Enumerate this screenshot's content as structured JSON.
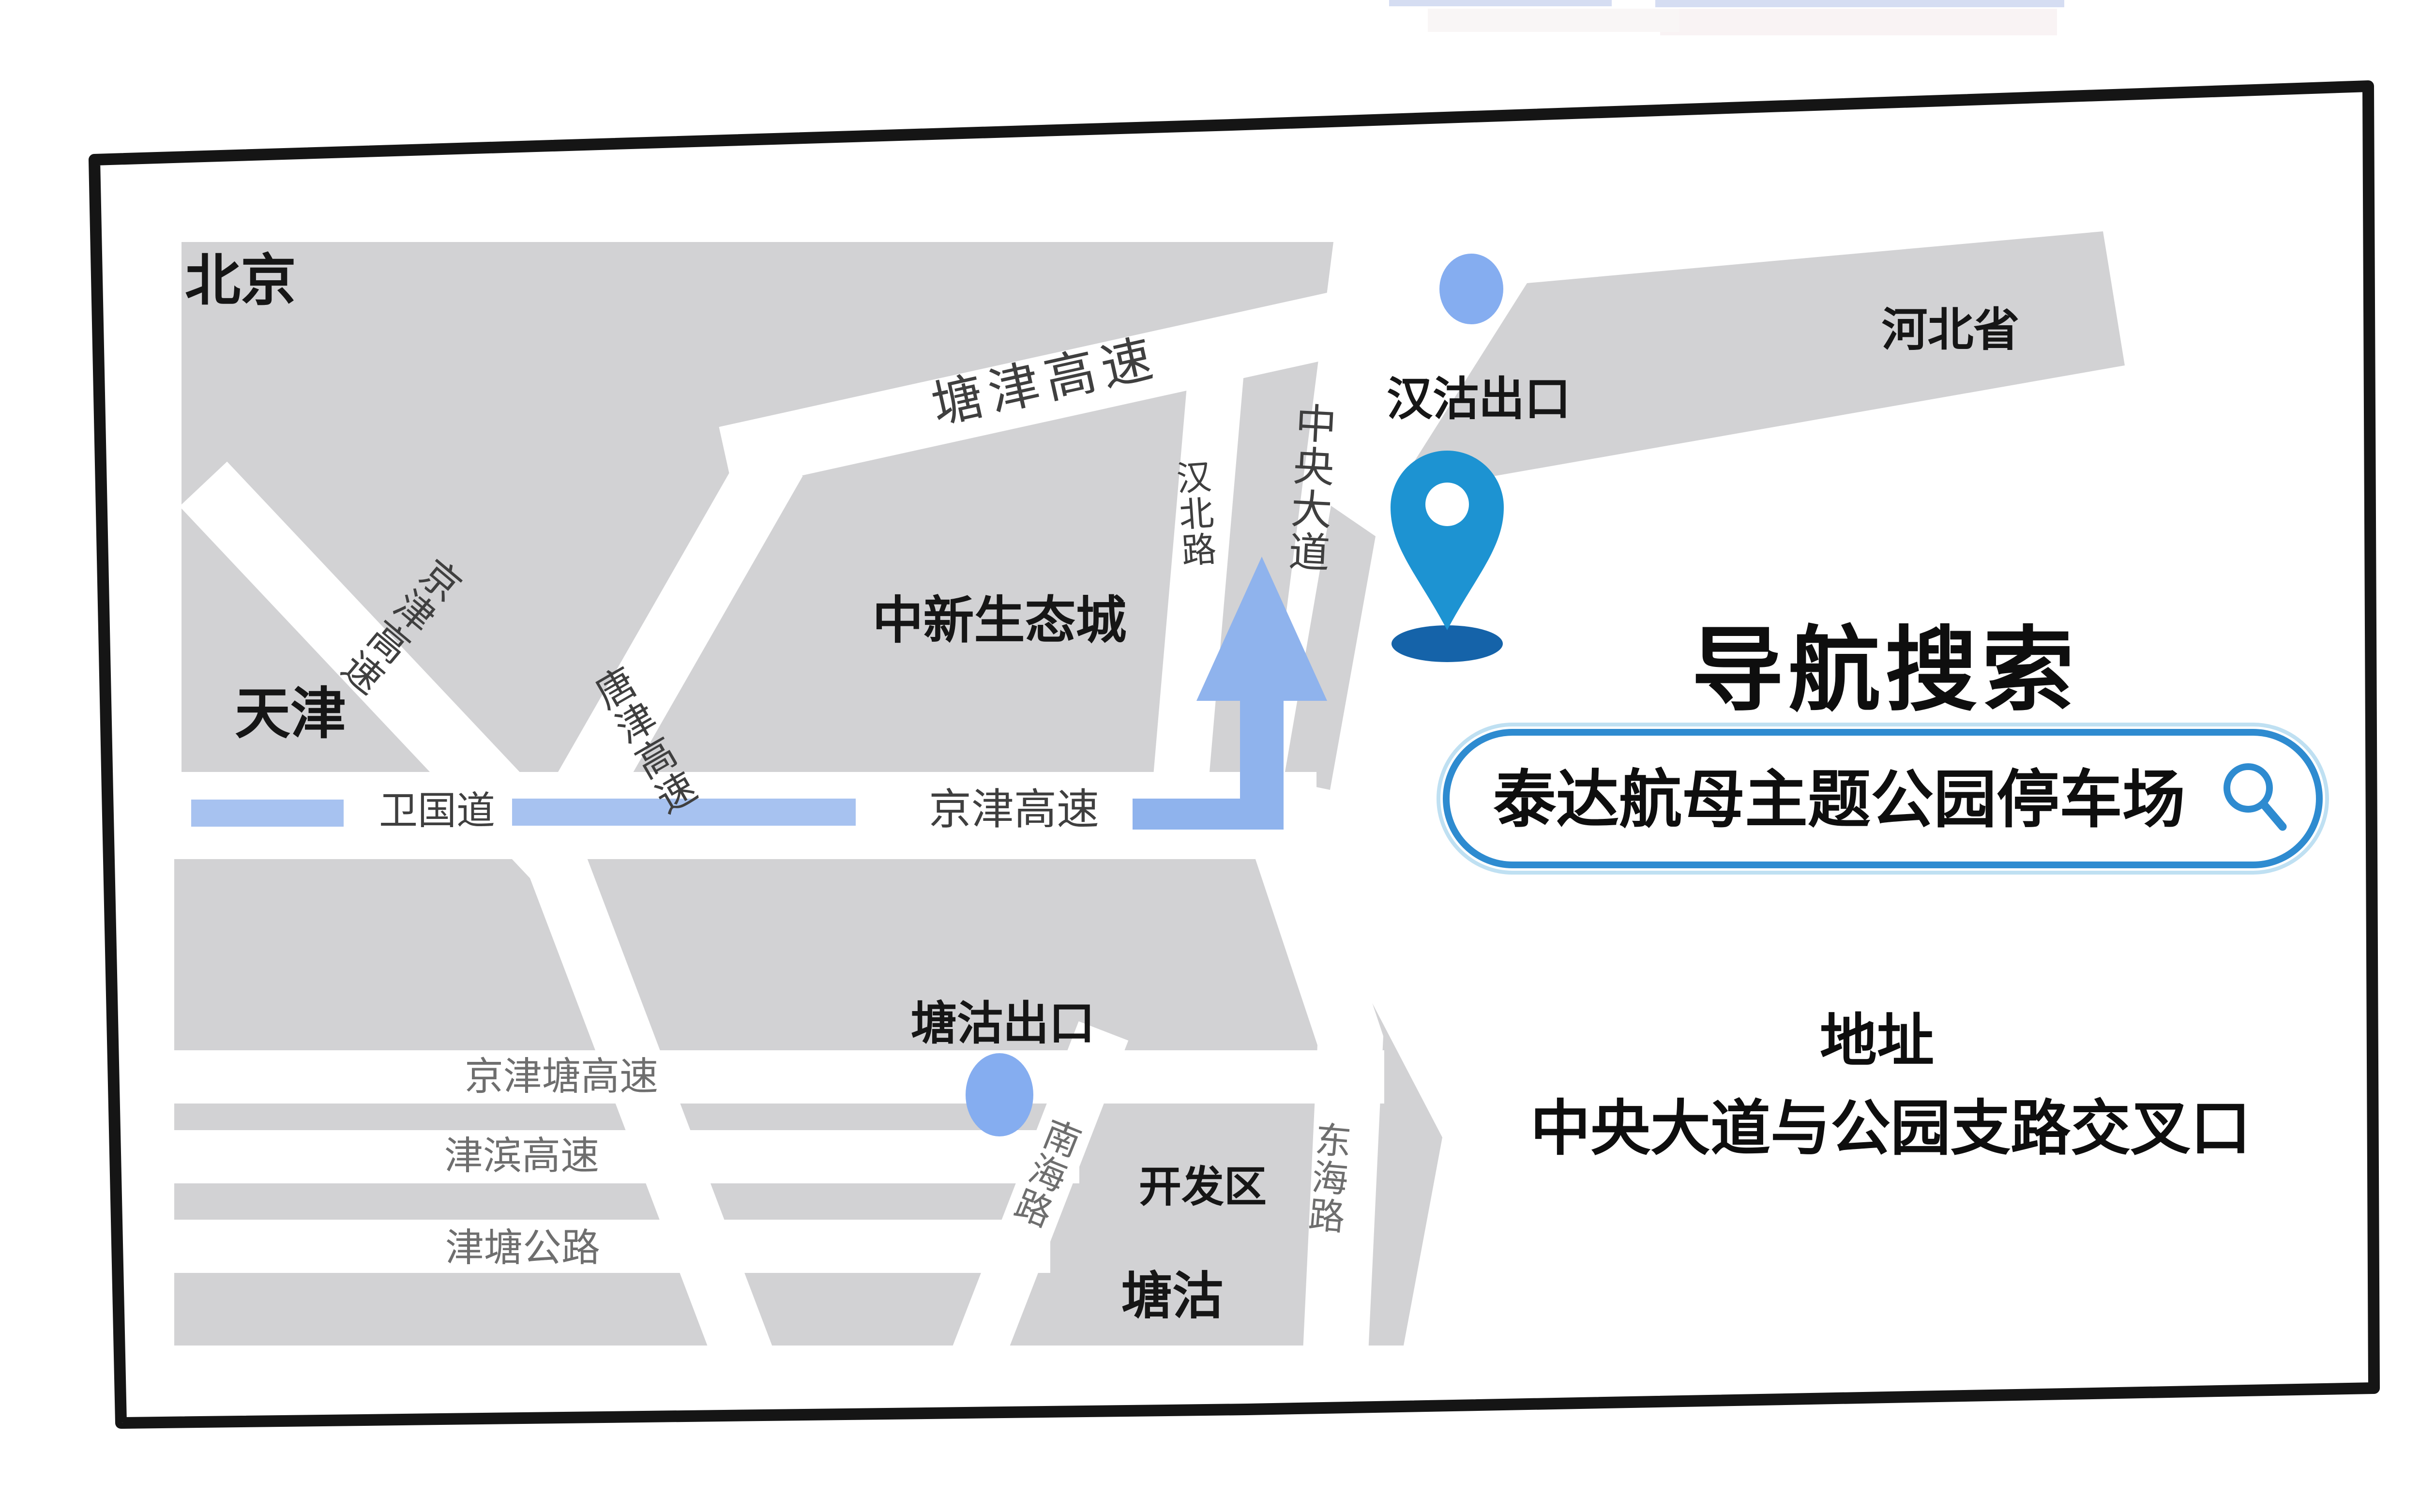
{
  "panel": {
    "title": "导航搜索",
    "search_value": "泰达航母主题公园停车场",
    "address_heading": "地址",
    "address_text": "中央大道与公园支路交叉口"
  },
  "map": {
    "region_labels": {
      "beijing": "北京",
      "tianjin": "天津",
      "zhongxin_eco_city": "中新生态城",
      "hebei_province": "河北省",
      "development_zone": "开发区",
      "tanggu": "塘沽"
    },
    "road_labels": {
      "tangjin_expressway_top": "塘津高速",
      "jingjin_expressway_diag": "京津高速",
      "tangjin_expressway_vert": "唐津高速",
      "weiguo_avenue": "卫国道",
      "jingjin_expressway_mid": "京津高速",
      "hanbei_road": "汉北路",
      "central_avenue": "中央大道",
      "jingjintang_expressway": "京津塘高速",
      "jinbin_expressway": "津滨高速",
      "jintang_highway": "津塘公路",
      "nanhai_road": "南海路",
      "donghai_road": "东海路"
    },
    "exit_labels": {
      "hangu_exit": "汉沽出口",
      "tanggu_exit": "塘沽出口"
    }
  },
  "icons": {
    "location_pin": "location-pin",
    "search": "magnifier",
    "route_arrow": "route-arrow-up",
    "exit_dot": "exit-dot"
  },
  "colors": {
    "block_gray": "#d2d2d4",
    "frame_black": "#151515",
    "accent_blue": "#2e8bd0",
    "route_blue": "#8fb3ed",
    "dash_blue": "#a7c2f0",
    "dot_blue": "#85adf0",
    "pin_blue": "#1d93d2",
    "pin_shadow": "#1563a9"
  }
}
